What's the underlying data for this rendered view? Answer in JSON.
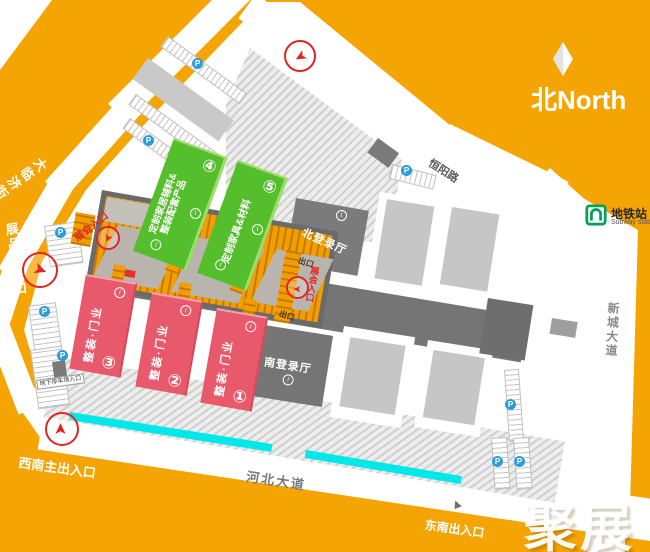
{
  "map": {
    "compass_label": "北North",
    "watermark": "聚展",
    "subway": {
      "title": "地铁站",
      "subtitle": "Subway station"
    },
    "streets": {
      "dalinji": "大临济街",
      "hengyang": "恒阳路",
      "xincheng": "新城大道",
      "hebei": "河北大道"
    },
    "entrances": {
      "northwest": "西北主出入口",
      "north": "北出入口",
      "southeast": "东南出入口",
      "southwest": "西南主出入口",
      "exhibits": "展品出入口",
      "underground_parking": "地下停车场入口",
      "expo_left": "展会入口",
      "expo_right": "展会入口",
      "exit_north": "出口",
      "exit_south": "出口"
    },
    "halls": {
      "h1_num": "①",
      "h1_label": "整装·门业",
      "h2_num": "②",
      "h2_label": "整装·门业",
      "h3_num": "③",
      "h3_label": "整装·门业",
      "h4_num": "④",
      "h4_label_1": "定制家居辅料&",
      "h4_label_2": "整装配套产品",
      "h5_num": "⑤",
      "h5_label": "定制家具&材料"
    },
    "buildings": {
      "north_registration": "北登录厅",
      "south_registration": "南登录厅"
    },
    "icons": {
      "info": "i",
      "parking": "P",
      "arrow": "➤",
      "triangle": "▲"
    },
    "colors": {
      "background": "#F4A503",
      "hall_green": "#55BE2D",
      "hall_red": "#E85A6B",
      "building_dark": "#6E6E6E",
      "cyan_lane": "#00E8E8",
      "accent_red": "#E32424",
      "parking_blue": "#2D9CDB",
      "subway_green": "#00A15D"
    }
  }
}
